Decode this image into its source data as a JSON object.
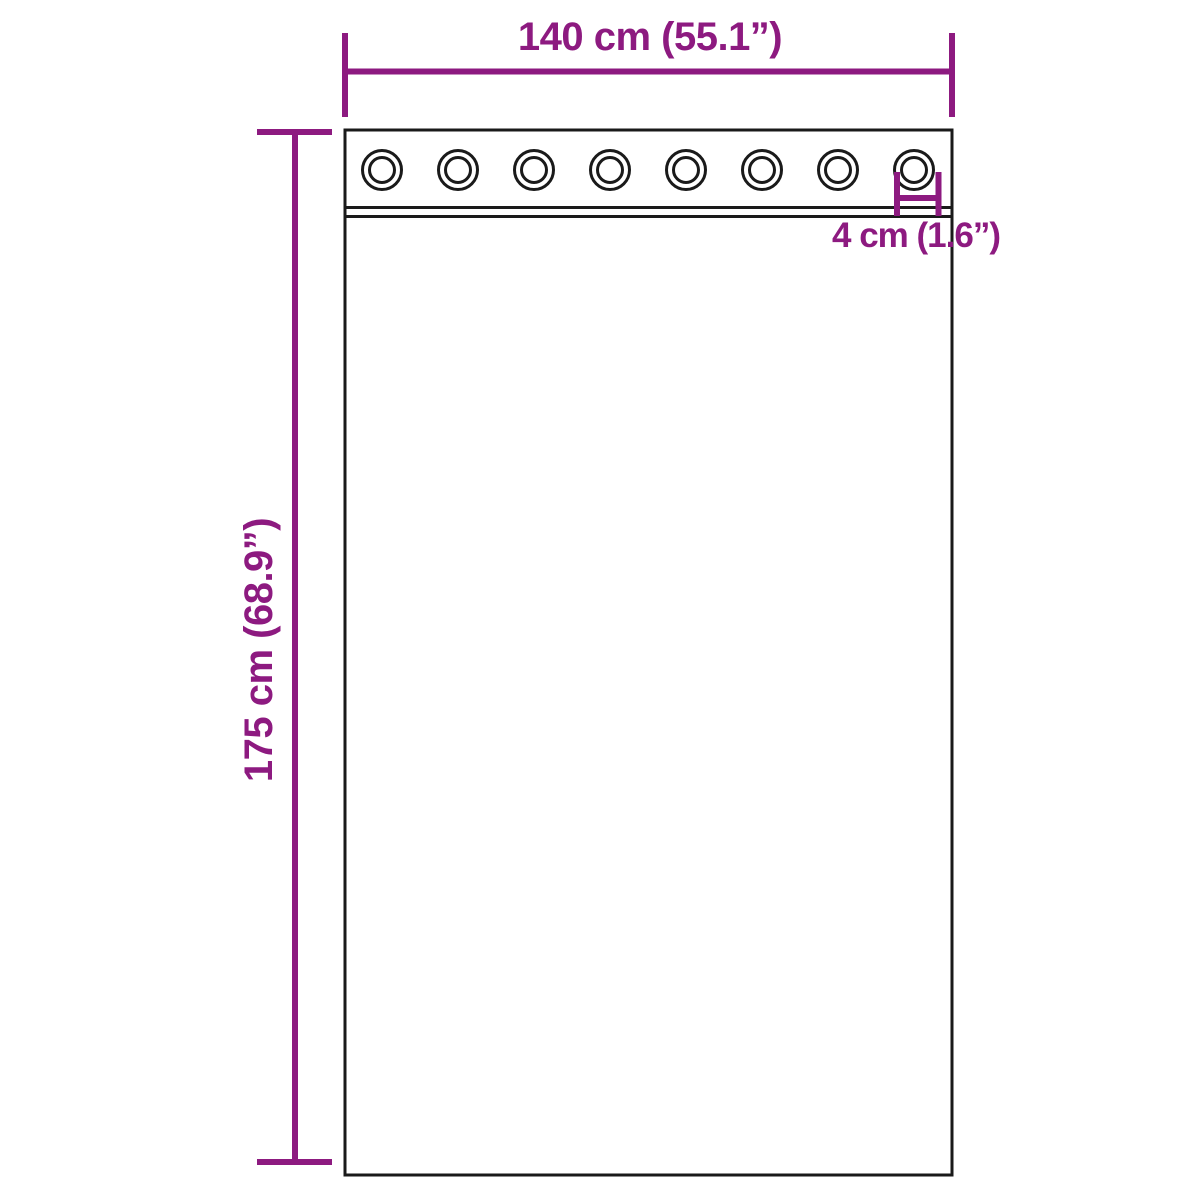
{
  "colors": {
    "dimension": "#8d1a80",
    "outline": "#1a1a1a",
    "background": "#ffffff"
  },
  "diagram": {
    "grommets": {
      "count": 8
    },
    "dimensions": {
      "width": {
        "label": "140 cm (55.1”)"
      },
      "height": {
        "label": "175 cm (68.9”)"
      },
      "grommet_diameter": {
        "label": "4 cm (1.6”)"
      }
    }
  }
}
